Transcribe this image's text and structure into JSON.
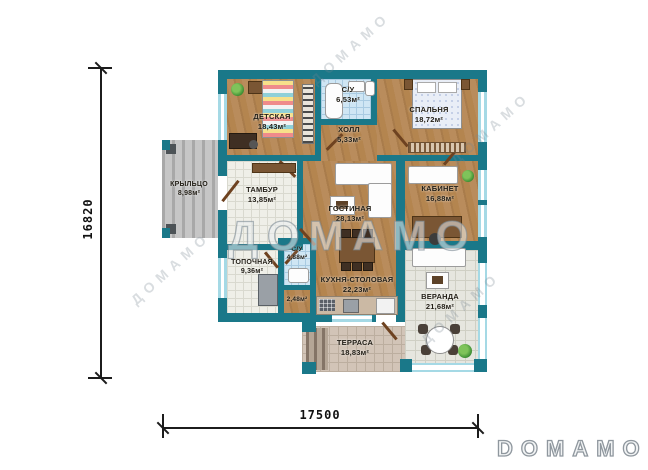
{
  "branding": {
    "logo": "DOMAMO",
    "watermark": "ДОМАМО"
  },
  "dimensions": {
    "vertical_mm": "16820",
    "horizontal_mm": "17500"
  },
  "rooms": [
    {
      "label": "ДЕТСКАЯ",
      "area": "18,43м²"
    },
    {
      "label": "С/У",
      "area": "6,53м²"
    },
    {
      "label": "ХОЛЛ",
      "area": "5,33м²"
    },
    {
      "label": "СПАЛЬНЯ",
      "area": "18,72м²"
    },
    {
      "label": "КРЫЛЬЦО",
      "area": "8,98м²"
    },
    {
      "label": "ТАМБУР",
      "area": "13,85м²"
    },
    {
      "label": "ГОСТИНАЯ",
      "area": "28,13м²"
    },
    {
      "label": "КАБИНЕТ",
      "area": "16,88м²"
    },
    {
      "label": "ТОПОЧНАЯ",
      "area": "9,36м²"
    },
    {
      "label": "С/У",
      "area": "4,88м²"
    },
    {
      "label": "",
      "area": "2,48м²"
    },
    {
      "label": "КУХНЯ-СТОЛОВАЯ",
      "area": "22,23м²"
    },
    {
      "label": "ВЕРАНДА",
      "area": "21,68м²"
    },
    {
      "label": "ТЕРРАСА",
      "area": "18,83м²"
    }
  ],
  "colors": {
    "wall": "#1a7889",
    "window": "#a5d9e5",
    "wood_floor": "#b18354",
    "tile_blue": "#cfe6f4",
    "tile_white": "#efefe8",
    "veranda_tile": "#e6e6df",
    "terrace_tile": "#d2c4b7",
    "porch": "#c0c0c0",
    "door": "#6e4220",
    "dimension": "#1c1c1c"
  }
}
